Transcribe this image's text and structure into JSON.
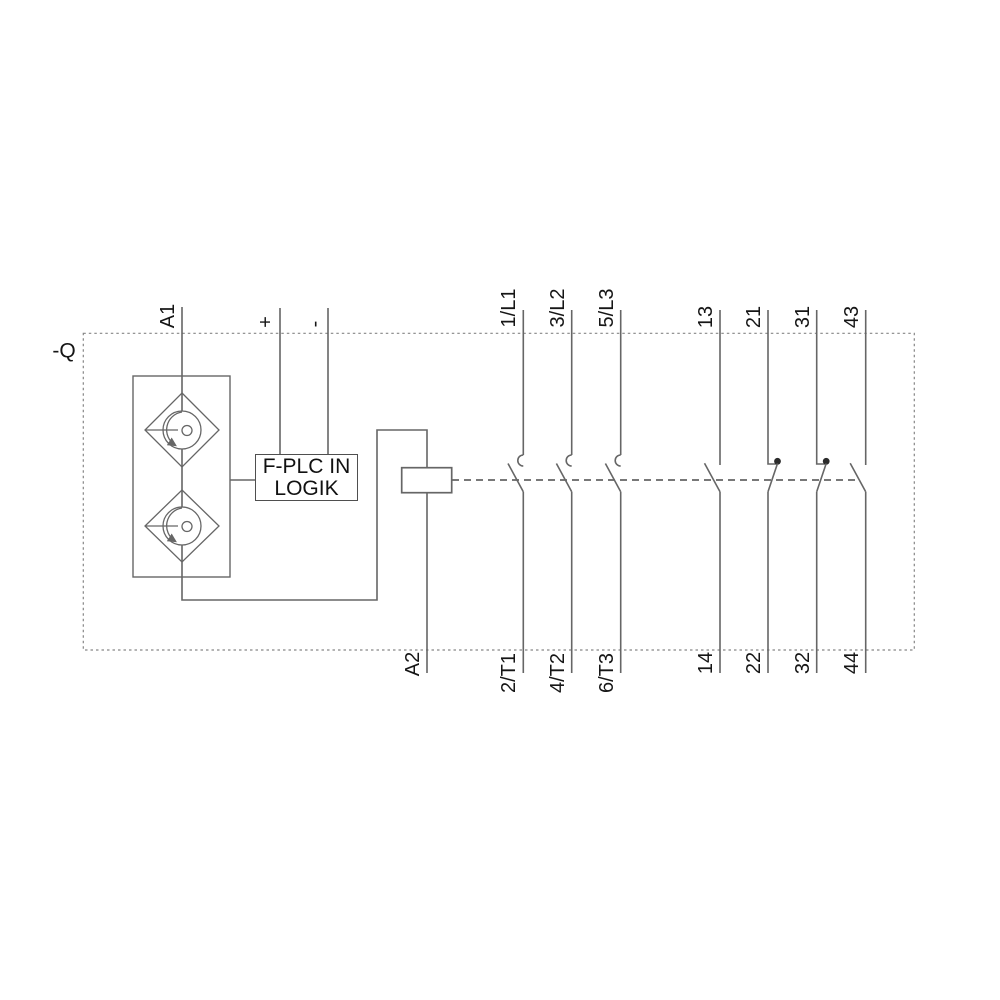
{
  "diagram": {
    "title_hint": "contactor wiring schematic",
    "device_label": "-Q",
    "logic_box": {
      "line1": "F-PLC IN",
      "line2": "LOGIK"
    },
    "coil_terminals": {
      "top": "A1",
      "bottom": "A2"
    },
    "control_supply": {
      "positive": "+",
      "negative": "-"
    },
    "main_poles": [
      {
        "top": "1/L1",
        "bottom": "2/T1"
      },
      {
        "top": "3/L2",
        "bottom": "4/T2"
      },
      {
        "top": "5/L3",
        "bottom": "6/T3"
      }
    ],
    "aux_contacts": [
      {
        "top": "13",
        "bottom": "14",
        "type": "NO"
      },
      {
        "top": "21",
        "bottom": "22",
        "type": "NC"
      },
      {
        "top": "31",
        "bottom": "32",
        "type": "NC"
      },
      {
        "top": "43",
        "bottom": "44",
        "type": "NO"
      }
    ],
    "colors": {
      "line": "#666666",
      "dashed_border": "#868686",
      "text": "#161616",
      "background": "#ffffff"
    }
  }
}
